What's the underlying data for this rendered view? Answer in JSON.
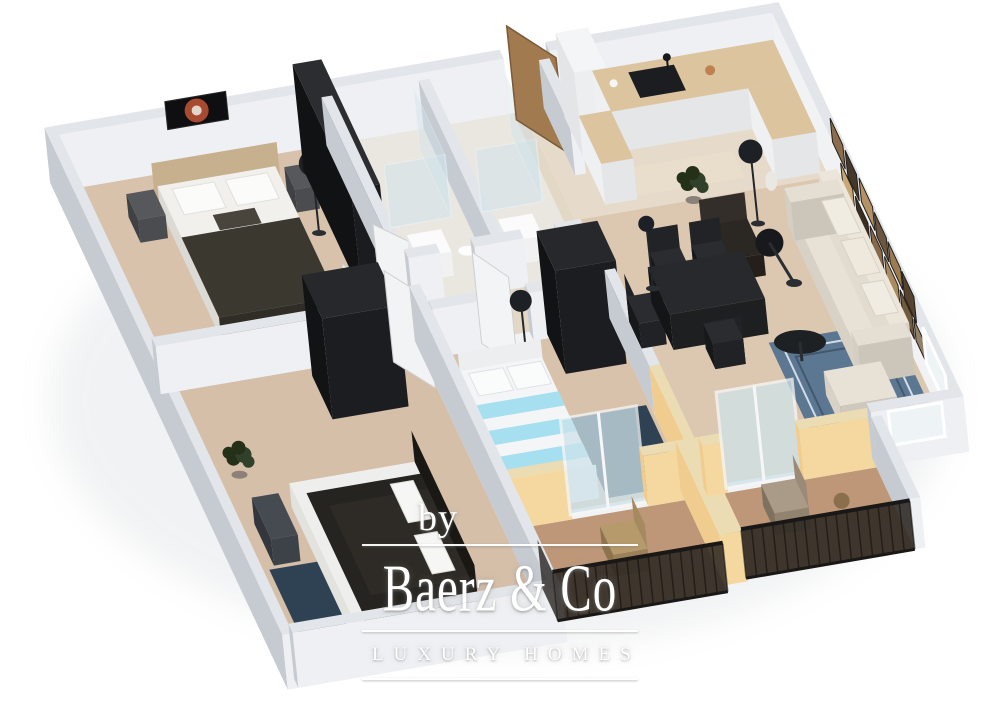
{
  "watermark": {
    "prefix": "by",
    "brand": "Baerz & Co",
    "tagline": "LUXURY HOMES"
  },
  "palette": {
    "background": "#ffffff",
    "wall_top": "#e2e6ea",
    "wall_shadow": "#c6cbd2",
    "wall_light": "#eef0f3",
    "accent_yellow": "#f0cd8f",
    "accent_yellow_light": "#f4d89f",
    "floor_wood": "#d8c2ac",
    "floor_pale": "#e6dbca",
    "floor_bath": "#eae6e0",
    "floor_terracotta": "#bd9778",
    "rug_navy": "#2e4254",
    "rug_blue": "#5b7792",
    "furniture_dark": "#1d1f22",
    "sofa_cream": "#e6e0d4",
    "counter_wood": "#dcc49f",
    "door_wood": "#a27a4f",
    "railing_dark": "#26221e",
    "glass": "#cfe3ea",
    "plant_green": "#31402a",
    "bed_stripe_cyan": "#a6dff0",
    "artwork_red": "#a84a30"
  },
  "scene": {
    "type": "3d-floor-plan-rendering",
    "rooms": [
      "master-bedroom",
      "second-bedroom",
      "third-bedroom",
      "bathroom-1",
      "bathroom-2",
      "entry-hall",
      "kitchen",
      "living-dining-room",
      "balcony-1",
      "balcony-2"
    ]
  }
}
